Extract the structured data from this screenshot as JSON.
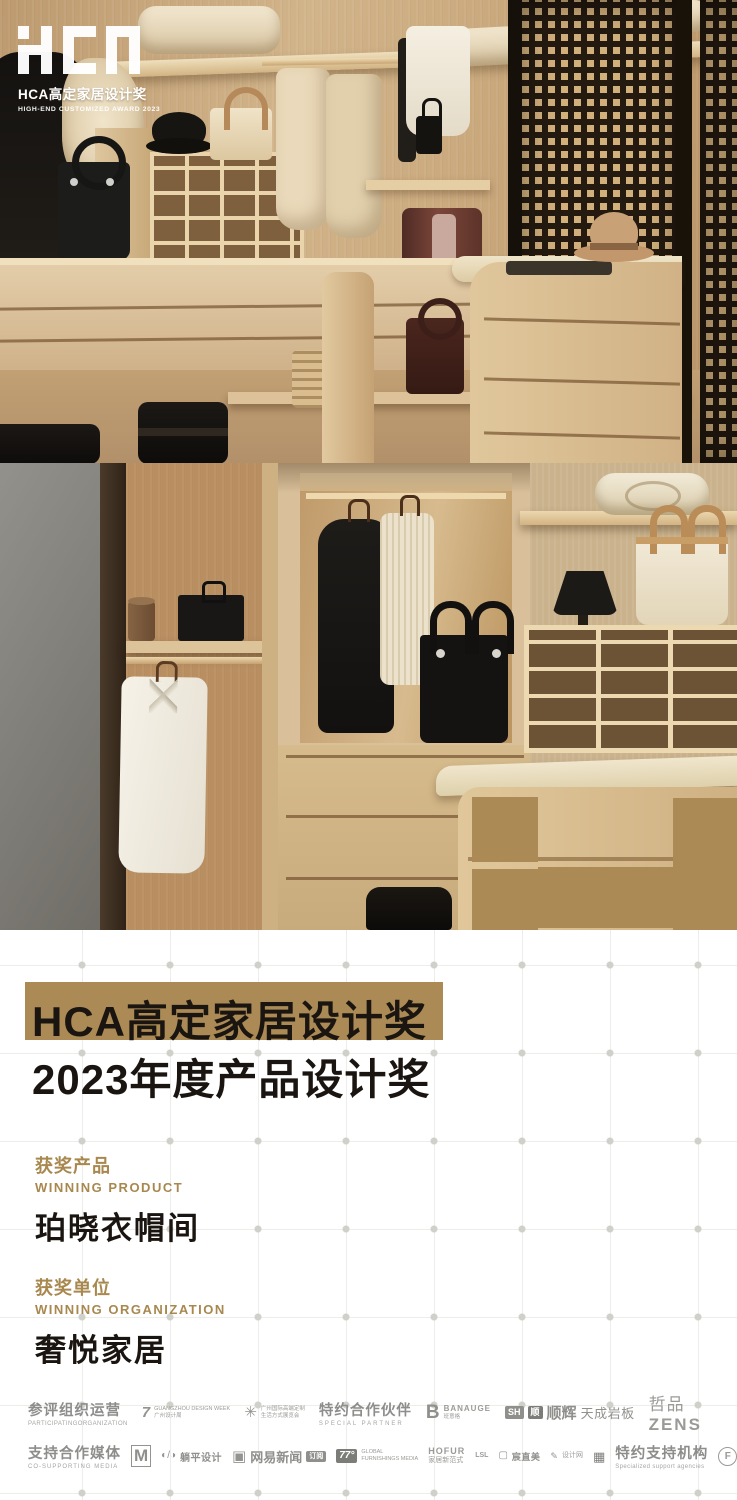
{
  "brand": {
    "logo_letters": "HCA",
    "logo_cn": "HCA高定家居设计奖",
    "logo_en": "HIGH-END CUSTOMIZED AWARD 2023"
  },
  "title": {
    "line1": "HCA高定家居设计奖",
    "line2": "2023年度产品设计奖"
  },
  "award": {
    "product_label_cn": "获奖产品",
    "product_label_en": "WINNING PRODUCT",
    "product_name": "珀晓衣帽间",
    "org_label_cn": "获奖单位",
    "org_label_en": "WINNING ORGANIZATION",
    "org_name": "奢悦家居"
  },
  "footer": {
    "row1": {
      "label": {
        "cn": "参评组织运营",
        "en": "PARTICIPATINGORGANIZATION"
      },
      "gzdw": {
        "icon": "7",
        "line1": "GUANGZHOU DESIGN WEEK",
        "line2": "广州设计周"
      },
      "expo": {
        "icon": "✳",
        "line1": "广州国际高端定制",
        "line2": "生活方式展览会"
      },
      "partner_label": {
        "cn": "特约合作伙伴",
        "en": "SPECIAL PARTNER"
      },
      "banauge": {
        "glyph": "B",
        "name": "BANAUGE",
        "sub": "班意格"
      },
      "shunhui": {
        "badge1": "SH",
        "badge2": "顺",
        "name": "顺辉",
        "sub": "天成岩板"
      },
      "zens": {
        "cn": "哲品",
        "en": "ZENS"
      }
    },
    "row2": {
      "label": {
        "cn": "支持合作媒体",
        "en": "CO-SUPPORTING MEDIA"
      },
      "m_media": {
        "glyph": "M"
      },
      "tangping": {
        "icon": "◐/◑",
        "name": "躺平设计"
      },
      "netease": {
        "icon": "▣",
        "name": "网易新闻",
        "badge": "订阅"
      },
      "gfm": {
        "num": "77°",
        "line1": "GLOBAL",
        "line2": "FURNISHINGS MEDIA"
      },
      "hofur": {
        "name": "HOFUR",
        "sub": "家居新范式"
      },
      "lsl": {
        "glyph": "LSL"
      },
      "chen": {
        "icon": "▢",
        "name": "宸直美"
      },
      "sjw": {
        "icon": "✎",
        "name": "设计网"
      },
      "dos": {
        "glyph": "▦"
      },
      "support_label": {
        "cn": "特约支持机构",
        "en": "Specialized support agencies"
      },
      "panshi": {
        "glyph": "F",
        "sub": "MEDIA"
      }
    }
  },
  "colors": {
    "gold": "#ab8a55",
    "ink": "#1a1510",
    "label-gold": "#a8884f",
    "gray": "#8f8f8c"
  }
}
